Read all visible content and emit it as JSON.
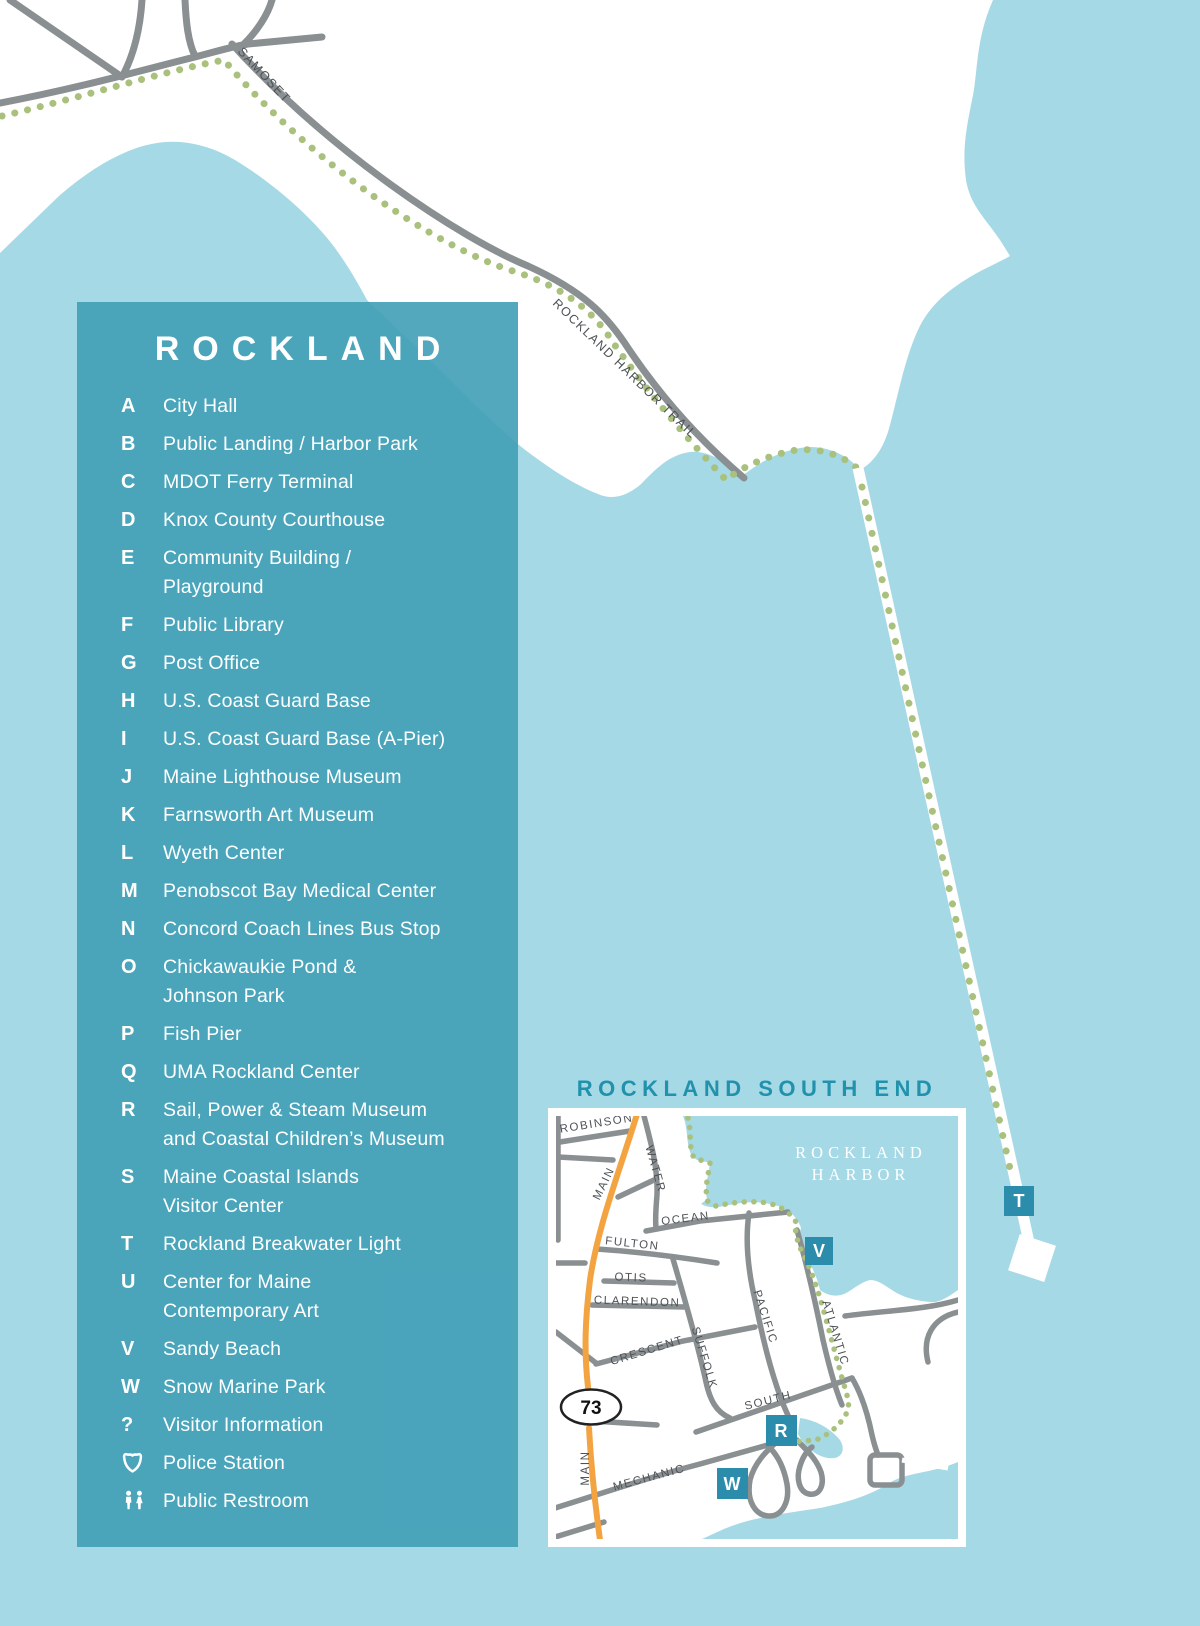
{
  "legend": {
    "title": "ROCKLAND",
    "items": [
      {
        "key": "A",
        "lines": [
          "City Hall"
        ]
      },
      {
        "key": "B",
        "lines": [
          "Public Landing / Harbor Park"
        ]
      },
      {
        "key": "C",
        "lines": [
          "MDOT Ferry Terminal"
        ]
      },
      {
        "key": "D",
        "lines": [
          "Knox County Courthouse"
        ]
      },
      {
        "key": "E",
        "lines": [
          "Community Building /",
          "Playground"
        ]
      },
      {
        "key": "F",
        "lines": [
          "Public Library"
        ]
      },
      {
        "key": "G",
        "lines": [
          "Post Office"
        ]
      },
      {
        "key": "H",
        "lines": [
          "U.S. Coast Guard Base"
        ]
      },
      {
        "key": "I",
        "lines": [
          "U.S. Coast Guard Base (A-Pier)"
        ]
      },
      {
        "key": "J",
        "lines": [
          "Maine Lighthouse Museum"
        ]
      },
      {
        "key": "K",
        "lines": [
          "Farnsworth Art Museum"
        ]
      },
      {
        "key": "L",
        "lines": [
          "Wyeth Center"
        ]
      },
      {
        "key": "M",
        "lines": [
          "Penobscot Bay Medical Center"
        ]
      },
      {
        "key": "N",
        "lines": [
          "Concord Coach Lines Bus Stop"
        ]
      },
      {
        "key": "O",
        "lines": [
          "Chickawaukie Pond &",
          "Johnson Park"
        ]
      },
      {
        "key": "P",
        "lines": [
          "Fish Pier"
        ]
      },
      {
        "key": "Q",
        "lines": [
          "UMA Rockland Center"
        ]
      },
      {
        "key": "R",
        "lines": [
          "Sail, Power & Steam Museum",
          "and Coastal Children’s Museum"
        ]
      },
      {
        "key": "S",
        "lines": [
          "Maine Coastal Islands",
          "Visitor Center"
        ]
      },
      {
        "key": "T",
        "lines": [
          "Rockland Breakwater Light"
        ]
      },
      {
        "key": "U",
        "lines": [
          "Center for Maine",
          "Contemporary Art"
        ]
      },
      {
        "key": "V",
        "lines": [
          "Sandy Beach"
        ]
      },
      {
        "key": "W",
        "lines": [
          "Snow Marine Park"
        ]
      },
      {
        "key": "?",
        "lines": [
          "Visitor Information"
        ]
      },
      {
        "key": "police",
        "lines": [
          "Police Station"
        ],
        "icon": "police"
      },
      {
        "key": "restroom",
        "lines": [
          "Public Restroom"
        ],
        "icon": "restroom"
      }
    ]
  },
  "map": {
    "samoset_label": "SAMOSET",
    "trail_label": "ROCKLAND HARBOR TRAIL",
    "breakwater_marker": "T"
  },
  "inset": {
    "title": "ROCKLAND SOUTH END",
    "harbor_label": [
      "ROCKLAND",
      "HARBOR"
    ],
    "route_shield": "73",
    "markers": {
      "sandy_beach": "V",
      "sail_power": "R",
      "snow_marine": "W"
    },
    "streets": {
      "robinson": "ROBINSON",
      "main_upper": "MAIN",
      "water": "WATER",
      "ocean": "OCEAN",
      "fulton": "FULTON",
      "otis": "OTIS",
      "clarendon": "CLARENDON",
      "crescent": "CRESCENT",
      "suffolk": "SUFFOLK",
      "pacific": "PACIFIC",
      "atlantic": "ATLANTIC",
      "south": "SOUTH",
      "mechanic": "MECHANIC",
      "main_lower": "MAIN"
    }
  },
  "colors": {
    "water": "#a6d9e6",
    "land": "#ffffff",
    "legend_panel": "#4aa4bb",
    "road_gray": "#8a8f92",
    "trail_green": "#a9c17c",
    "main_street_orange": "#f3a441",
    "marker_teal": "#2b8dab",
    "inset_title_teal": "#2191ac",
    "street_label_gray": "#4d5256"
  }
}
